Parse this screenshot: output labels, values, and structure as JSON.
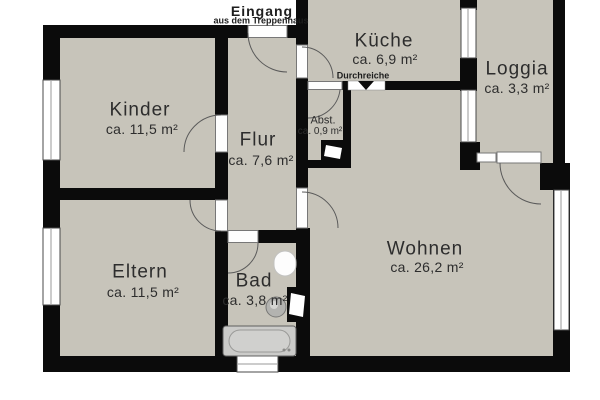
{
  "plan": {
    "entrance": {
      "title": "Eingang",
      "subtitle": "aus dem Treppenhaus"
    },
    "rooms": [
      {
        "name": "Kinder",
        "area": "ca. 11,5 m²"
      },
      {
        "name": "Flur",
        "area": "ca. 7,6 m²"
      },
      {
        "name": "Küche",
        "area": "ca. 6,9 m²"
      },
      {
        "name": "Loggia",
        "area": "ca. 3,3 m²"
      },
      {
        "name": "Abst.",
        "area": "ca. 0,9 m²"
      },
      {
        "name": "Eltern",
        "area": "ca. 11,5 m²"
      },
      {
        "name": "Bad",
        "area": "ca. 3,8 m²"
      },
      {
        "name": "Wohnen",
        "area": "ca. 26,2 m²"
      }
    ],
    "annotations": {
      "pass_through": "Durchreiche"
    },
    "colors": {
      "floor": "#c7c4ba",
      "wall": "#0b0b0b",
      "background": "#ffffff",
      "text": "#2d2d2d"
    }
  }
}
